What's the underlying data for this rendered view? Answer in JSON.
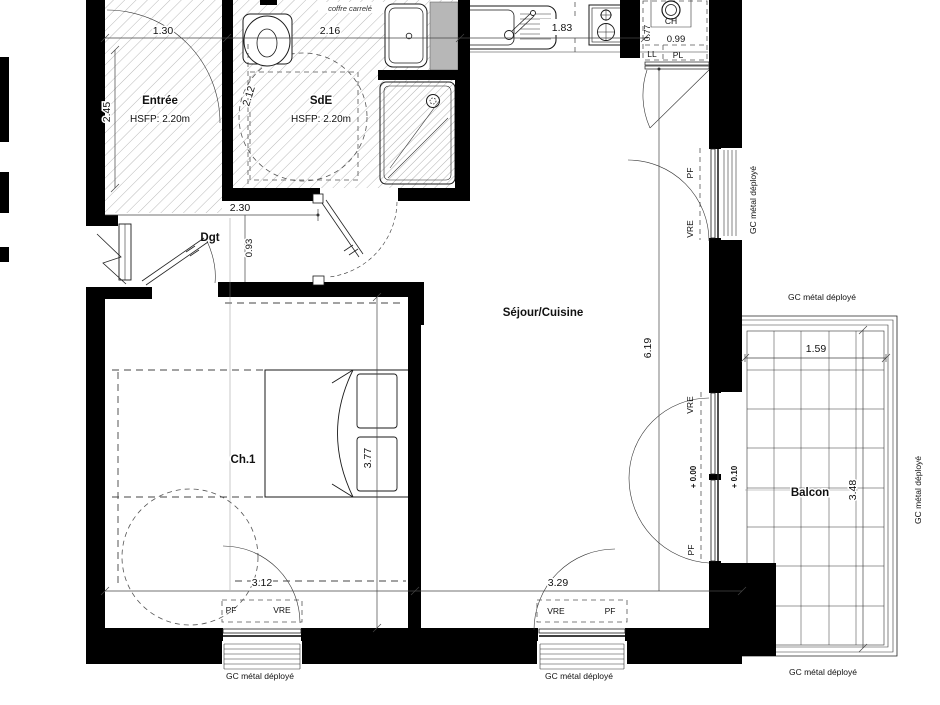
{
  "drawing": {
    "rooms": {
      "entree": {
        "name": "Entrée",
        "ceiling": "HSFP: 2.20m"
      },
      "sde": {
        "name": "SdE",
        "ceiling": "HSFP: 2.20m"
      },
      "dgt": {
        "name": "Dgt"
      },
      "sejour": {
        "name": "Séjour/Cuisine"
      },
      "ch1": {
        "name": "Ch.1"
      },
      "balcon": {
        "name": "Balcon"
      }
    },
    "dims": {
      "d130": "1.30",
      "d216": "2.16",
      "d183": "1.83",
      "d077": "0.77",
      "d099": "0.99",
      "d245": "2.45",
      "d212": "2.12",
      "d230": "2.30",
      "d093": "0.93",
      "d619": "6.19",
      "d377": "3.77",
      "d312": "3.12",
      "d329": "3.29",
      "d159": "1.59",
      "d348": "3.48"
    },
    "levels": {
      "zero": "+ 0.00",
      "ten": "+ 0.10"
    },
    "labels": {
      "coffre": "coffre carrelé",
      "gc": "GC métal déployé",
      "pf": "PF",
      "vre": "VRE",
      "ch": "CH",
      "ll": "LL",
      "pl": "PL"
    },
    "colors": {
      "wall": "#000000",
      "duct": "#b7b7b7",
      "hatch": "#9a9a9a"
    }
  }
}
